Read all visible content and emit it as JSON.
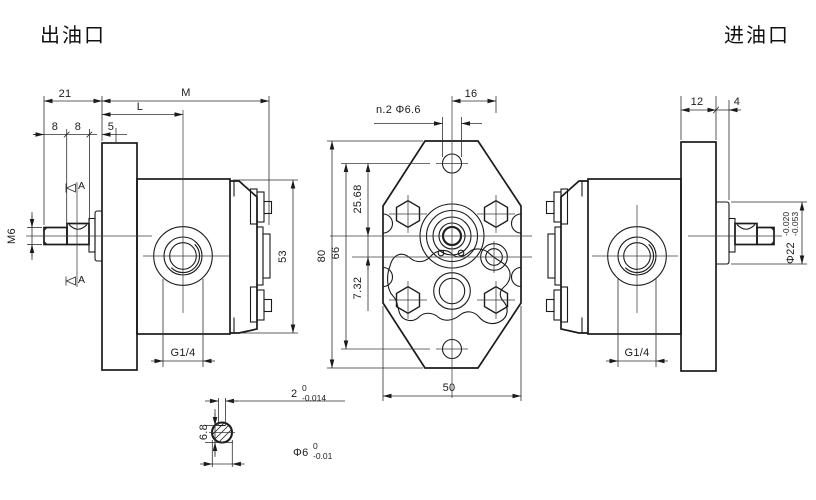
{
  "title_labels": {
    "outlet": "出油口",
    "inlet": "进油口"
  },
  "left_view": {
    "dim_21": "21",
    "dim_M": "M",
    "dim_L": "L",
    "dim_8a": "8",
    "dim_8b": "8",
    "dim_5": "5",
    "thread_label": "M6",
    "section_marker_top": "A",
    "section_marker_bottom": "A",
    "dim_53": "53",
    "port_label": "G1/4"
  },
  "front_view": {
    "dim_80": "80",
    "dim_66": "66",
    "dim_25_68": "25.68",
    "dim_7_32": "7.32",
    "dim_50": "50",
    "dim_16": "16",
    "holes_label": "n.2 Φ6.6"
  },
  "right_view": {
    "dim_12": "12",
    "dim_4": "4",
    "port_label": "G1/4",
    "shaft_dia": "Φ22",
    "shaft_tol_upper": "-0.020",
    "shaft_tol_lower": "-0.053"
  },
  "section_detail": {
    "key_width": "2",
    "key_width_tol_upper": "0",
    "key_width_tol_lower": "-0.014",
    "key_height": "6.8",
    "dia": "Φ6",
    "dia_tol_upper": "0",
    "dia_tol_lower": "-0.01"
  }
}
